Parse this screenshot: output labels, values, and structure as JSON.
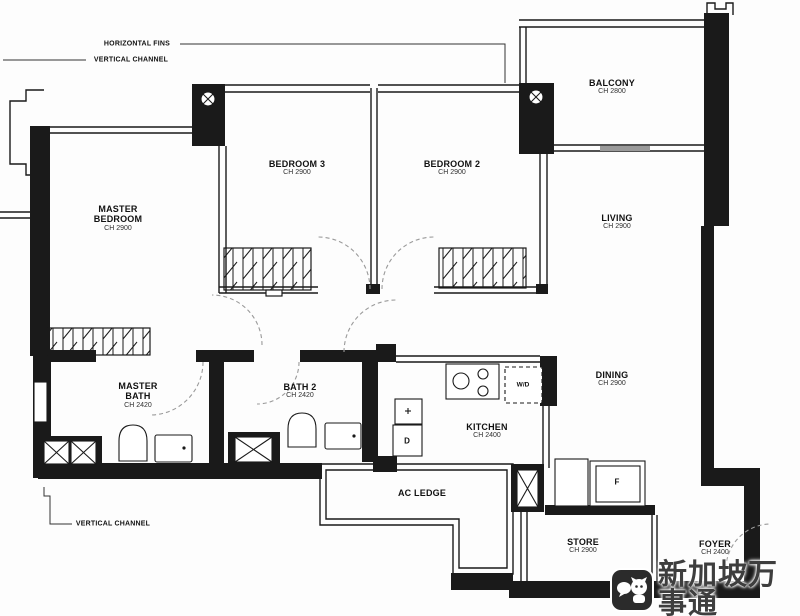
{
  "annotations": {
    "horizontal_fins": "HORIZONTAL FINS",
    "vertical_channel_top": "VERTICAL CHANNEL",
    "vertical_channel_bottom": "VERTICAL CHANNEL"
  },
  "rooms": {
    "master_bedroom": {
      "name": "MASTER\nBEDROOM",
      "ch": "CH 2900"
    },
    "bedroom3": {
      "name": "BEDROOM 3",
      "ch": "CH 2900"
    },
    "bedroom2": {
      "name": "BEDROOM 2",
      "ch": "CH 2900"
    },
    "balcony": {
      "name": "BALCONY",
      "ch": "CH 2800"
    },
    "living": {
      "name": "LIVING",
      "ch": "CH 2900"
    },
    "dining": {
      "name": "DINING",
      "ch": "CH 2900"
    },
    "master_bath": {
      "name": "MASTER\nBATH",
      "ch": "CH 2420"
    },
    "bath2": {
      "name": "BATH 2",
      "ch": "CH 2420"
    },
    "kitchen": {
      "name": "KITCHEN",
      "ch": "CH 2400"
    },
    "ac_ledge": {
      "name": "AC LEDGE"
    },
    "store": {
      "name": "STORE",
      "ch": "CH 2900"
    },
    "foyer": {
      "name": "FOYER",
      "ch": "CH 2400"
    }
  },
  "appliances": {
    "washer_dryer": "W/D",
    "dryer": "D",
    "fridge": "F"
  },
  "watermark": {
    "text": "新加坡万事通"
  },
  "colors": {
    "wall": "#1a1a1a",
    "background": "#ffffff",
    "watermark_text": "#3e3e3e"
  }
}
